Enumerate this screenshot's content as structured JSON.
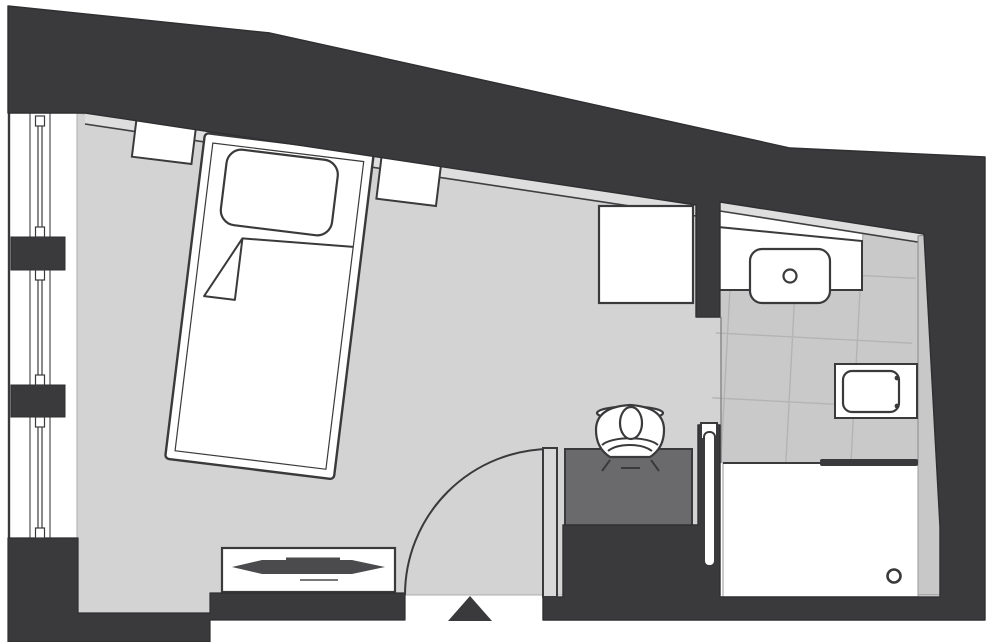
{
  "title": "Hotel guest room floor plan",
  "colors": {
    "background": "#ffffff",
    "wall": "#3a3a3c",
    "outline": "#2f2f31",
    "floor": "#d3d3d4",
    "skirting": "#dedede",
    "tile": "#c9c9ca",
    "tile_line": "#b4b4b5",
    "ledge": "#c8c8c9",
    "desk": "#6a6a6c",
    "door_leaf": "#d8d8d9",
    "radiator_fin": "#4b4b4d",
    "white": "#ffffff",
    "frame_line": "#5a5a5c"
  },
  "rooms": [
    {
      "id": "bedroom",
      "label": "bedroom-living-area"
    },
    {
      "id": "bathroom",
      "label": "bathroom-with-shower"
    }
  ],
  "elements": [
    {
      "id": "bed",
      "label": "single-bed-with-pillow-and-duvet"
    },
    {
      "id": "nightstand-left",
      "label": "left-nightstand"
    },
    {
      "id": "nightstand-right",
      "label": "right-nightstand"
    },
    {
      "id": "wardrobe",
      "label": "wardrobe-closet"
    },
    {
      "id": "desk",
      "label": "work-desk"
    },
    {
      "id": "person",
      "label": "person-seated-at-desk"
    },
    {
      "id": "radiator",
      "label": "radiator-sideboard"
    },
    {
      "id": "entry-door",
      "label": "entrance-door-with-swing"
    },
    {
      "id": "entrance-arrow",
      "label": "entrance-direction-marker"
    },
    {
      "id": "windows",
      "label": "window-wall-three-segments"
    },
    {
      "id": "vanity",
      "label": "bathroom-vanity-with-sink"
    },
    {
      "id": "toilet",
      "label": "wall-mounted-toilet"
    },
    {
      "id": "shower",
      "label": "walk-in-shower-with-drain"
    },
    {
      "id": "partition",
      "label": "bathroom-partition-sliding-panel"
    }
  ]
}
